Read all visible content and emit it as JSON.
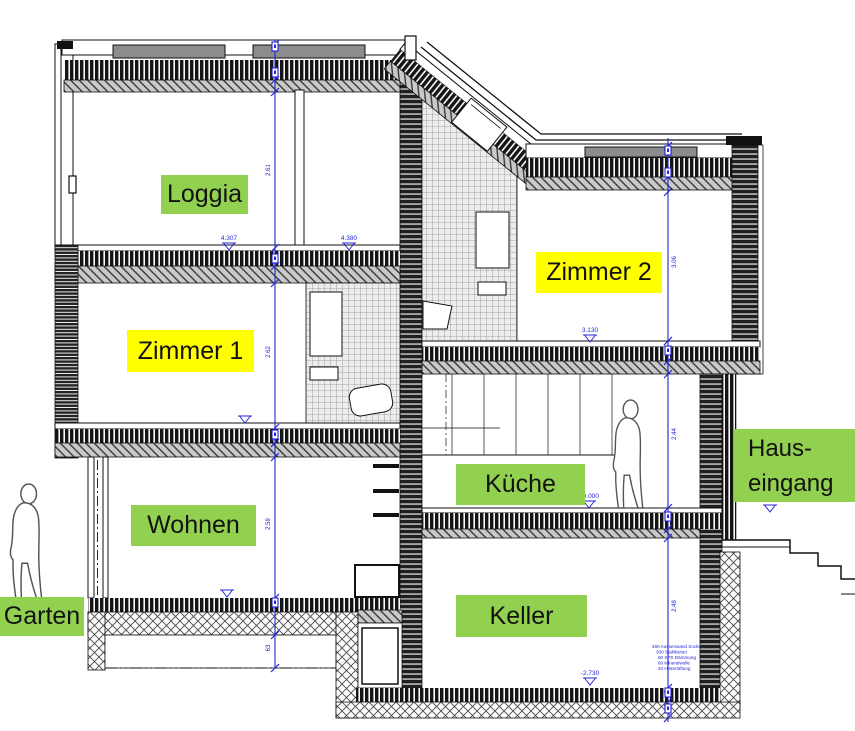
{
  "colors": {
    "label_green": "#92d050",
    "label_yellow": "#ffff00",
    "dimension_blue": "#2424d8",
    "line_black": "#111111"
  },
  "rooms": {
    "loggia": "Loggia",
    "zimmer1": "Zimmer 1",
    "zimmer2": "Zimmer 2",
    "wohnen": "Wohnen",
    "kueche": "Küche",
    "keller": "Keller",
    "garten": "Garten",
    "hauseingang_line1": "Haus-",
    "hauseingang_line2": "eingang"
  },
  "levels": {
    "loggia_left": "4.307",
    "loggia_right": "4.380",
    "zimmer2": "3.130",
    "kueche": "±0.000",
    "hauseingang": "±0.000",
    "keller": "-2.730"
  },
  "dims": {
    "left": [
      "2.61",
      "2.62",
      "2.59",
      "63"
    ],
    "right": [
      "3.06",
      "2.44",
      "2.48"
    ]
  },
  "wall_legend": [
    "480 Aussenwand Sockel",
    "300 Stahlbeton",
    "60 XPS Dämmung",
    "60 Mineralwolle",
    "20 Hinterlüftung"
  ]
}
